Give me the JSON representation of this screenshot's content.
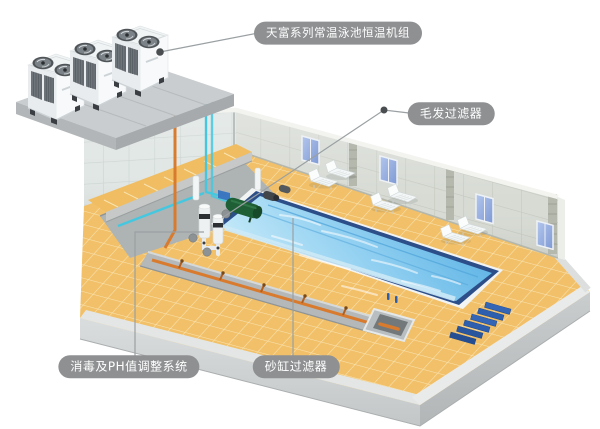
{
  "page": {
    "background_color": "#ffffff"
  },
  "diagram": {
    "callouts": [
      {
        "id": "heat-pump-unit",
        "text": "天富系列常温泳池恒温机组"
      },
      {
        "id": "hair-filter",
        "text": "毛发过滤器"
      },
      {
        "id": "disinfection-ph-system",
        "text": "消毒及PH值调整系统"
      },
      {
        "id": "sand-filter",
        "text": "砂缸过滤器"
      }
    ],
    "callout_style": {
      "background": "#8e9092",
      "text_color": "#ffffff"
    },
    "scene": {
      "heat_pump_units": 3,
      "windows": 4,
      "lounger_pairs": 3,
      "pool_water_color": "#6cbde8",
      "pool_edge_color": "#2c4f8a",
      "floor_tile_color": "#f2c068",
      "hot_pipe_color": "#d97b2e",
      "cold_pipe_color": "#45c8df",
      "sand_filter_tank_color": "#1f5f36",
      "steps_color": "#2e5fae"
    }
  }
}
